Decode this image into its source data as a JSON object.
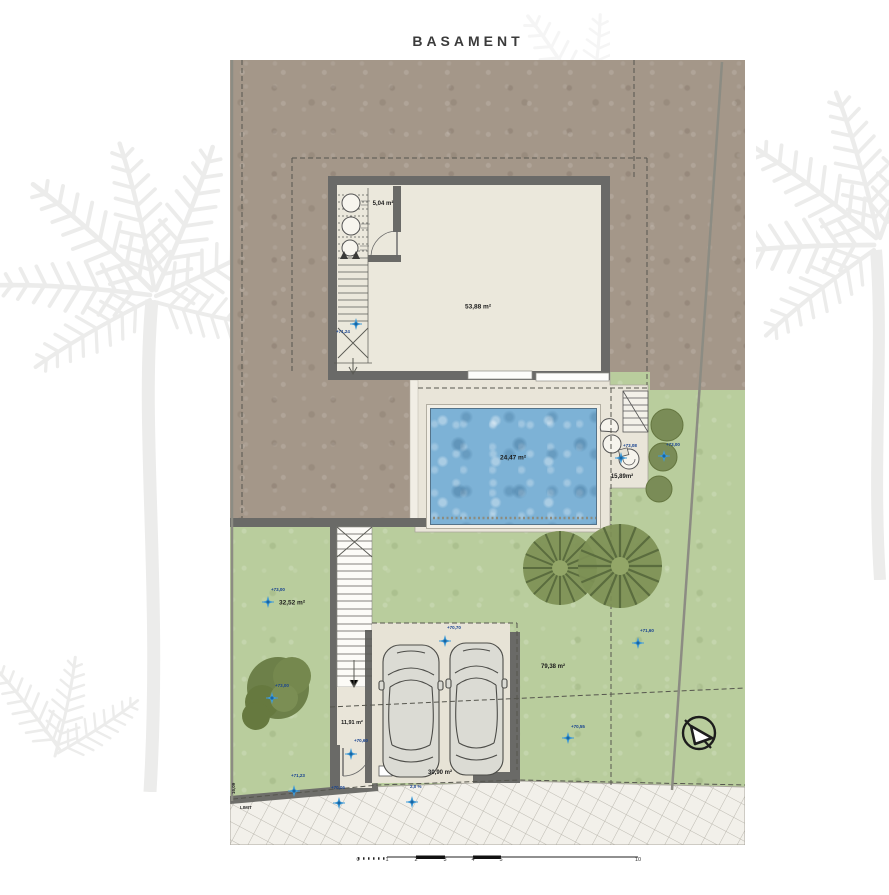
{
  "title": "BASAMENT",
  "rooms": {
    "main": "53,88 m²",
    "small": "5,04 m²",
    "entry": "11,91 m²",
    "carport": "30,90 m²"
  },
  "outdoor": {
    "pool": "24,47 m²",
    "terrace": "15,89m²",
    "garden_left": "32,52 m²",
    "garden_right": "79,38 m²"
  },
  "elevation_markers": [
    {
      "label": "+71,24"
    },
    {
      "label": "+73,08"
    },
    {
      "label": "+73,00"
    },
    {
      "label": "+73,00"
    },
    {
      "label": "+70,70"
    },
    {
      "label": "+70,60"
    },
    {
      "label": "+71,60"
    },
    {
      "label": "+70,55"
    },
    {
      "label": "+71,23"
    },
    {
      "label": "+70,06"
    },
    {
      "label": "2,0 %"
    },
    {
      "label": "+73,00"
    }
  ],
  "scale_bar": {
    "labels": [
      "0",
      "1",
      "2",
      "3",
      "4",
      "5",
      "10"
    ]
  },
  "boundary": {
    "dim_label": "16,09",
    "limit_label": "LIMIT"
  },
  "colors": {
    "earth": "#a49789",
    "lawn": "#b9cd9d",
    "wall": "#6a6a68",
    "pool_water": "#7db2d6",
    "terrace": "#e9e5d9",
    "interior": "#ebe8dc",
    "marker_blue": "#3f9ad6",
    "marker_text": "#16418f"
  }
}
